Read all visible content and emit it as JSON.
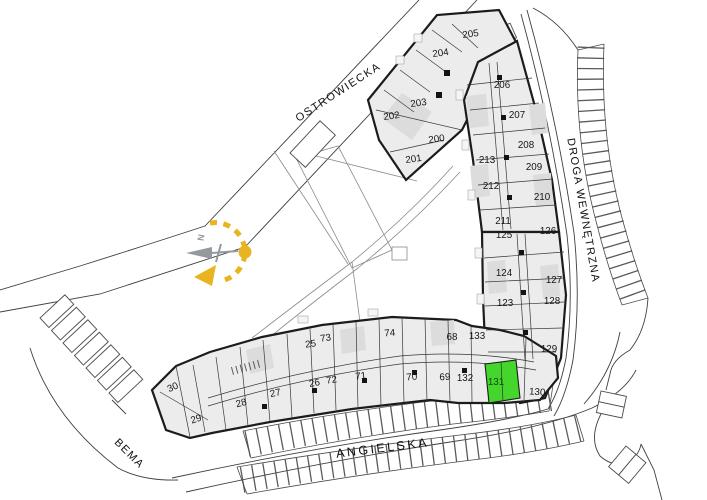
{
  "map": {
    "streets": {
      "ostrowiecka": {
        "label": "OSTROWIECKA"
      },
      "droga_wewnetrzna": {
        "label": "DROGA WEWNĘTRZNA"
      },
      "angielska": {
        "label": "ANGIELSKA"
      },
      "bema": {
        "label": "BEMA"
      }
    },
    "compass": {
      "north_label": "N",
      "color": "#e8b41f"
    },
    "highlighted_unit": {
      "number": "131",
      "color": "#44d62c"
    },
    "colors": {
      "building_fill": "#ececec",
      "wall": "#1c1c1c",
      "street_line": "#3f3f3f",
      "highlight": "#44d62c",
      "compass_yellow": "#e8b41f"
    },
    "units": [
      {
        "number": "202",
        "x": 392,
        "y": 119,
        "rot": -8
      },
      {
        "number": "203",
        "x": 419,
        "y": 106,
        "rot": -8
      },
      {
        "number": "200",
        "x": 437,
        "y": 142,
        "rot": -8
      },
      {
        "number": "201",
        "x": 414,
        "y": 162,
        "rot": -8
      },
      {
        "number": "204",
        "x": 441,
        "y": 56,
        "rot": -8
      },
      {
        "number": "205",
        "x": 471,
        "y": 37,
        "rot": -8
      },
      {
        "number": "206",
        "x": 502,
        "y": 88,
        "rot": 0
      },
      {
        "number": "207",
        "x": 517,
        "y": 118,
        "rot": 0
      },
      {
        "number": "208",
        "x": 526,
        "y": 148,
        "rot": 0
      },
      {
        "number": "213",
        "x": 487,
        "y": 163,
        "rot": 0
      },
      {
        "number": "209",
        "x": 534,
        "y": 170,
        "rot": 0
      },
      {
        "number": "212",
        "x": 491,
        "y": 189,
        "rot": 0
      },
      {
        "number": "210",
        "x": 542,
        "y": 200,
        "rot": 0
      },
      {
        "number": "211",
        "x": 503,
        "y": 224,
        "rot": 0
      },
      {
        "number": "125",
        "x": 504,
        "y": 238,
        "rot": 0
      },
      {
        "number": "126",
        "x": 548,
        "y": 234,
        "rot": 0
      },
      {
        "number": "124",
        "x": 504,
        "y": 276,
        "rot": 0
      },
      {
        "number": "127",
        "x": 554,
        "y": 283,
        "rot": 0
      },
      {
        "number": "123",
        "x": 505,
        "y": 306,
        "rot": 0
      },
      {
        "number": "128",
        "x": 552,
        "y": 304,
        "rot": 0
      },
      {
        "number": "129",
        "x": 549,
        "y": 352,
        "rot": 0
      },
      {
        "number": "133",
        "x": 477,
        "y": 339,
        "rot": 0
      },
      {
        "number": "68",
        "x": 452,
        "y": 340,
        "rot": 0
      },
      {
        "number": "74",
        "x": 390,
        "y": 336,
        "rot": -4
      },
      {
        "number": "73",
        "x": 326,
        "y": 341,
        "rot": -8
      },
      {
        "number": "25",
        "x": 311,
        "y": 347,
        "rot": -8
      },
      {
        "number": "132",
        "x": 465,
        "y": 381,
        "rot": 0
      },
      {
        "number": "131",
        "x": 496,
        "y": 385,
        "rot": 0,
        "highlighted": true
      },
      {
        "number": "130",
        "x": 537,
        "y": 395,
        "rot": 4
      },
      {
        "number": "69",
        "x": 445,
        "y": 380,
        "rot": -2
      },
      {
        "number": "70",
        "x": 412,
        "y": 380,
        "rot": -4
      },
      {
        "number": "71",
        "x": 361,
        "y": 379,
        "rot": -6
      },
      {
        "number": "72",
        "x": 332,
        "y": 383,
        "rot": -8
      },
      {
        "number": "26",
        "x": 315,
        "y": 386,
        "rot": -10
      },
      {
        "number": "27",
        "x": 276,
        "y": 396,
        "rot": -12
      },
      {
        "number": "28",
        "x": 242,
        "y": 406,
        "rot": -15
      },
      {
        "number": "29",
        "x": 197,
        "y": 422,
        "rot": -18
      },
      {
        "number": "30",
        "x": 174,
        "y": 390,
        "rot": -24
      }
    ]
  }
}
